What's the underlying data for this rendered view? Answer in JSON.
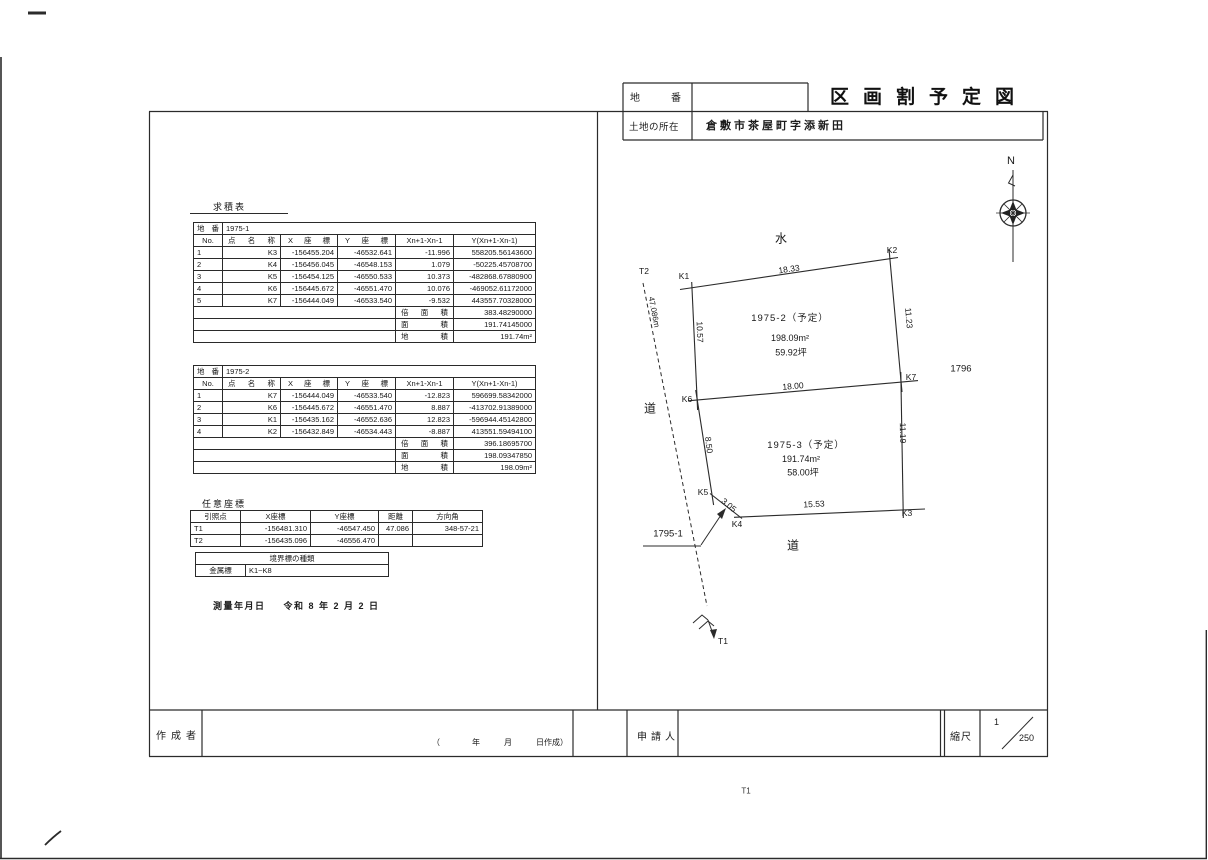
{
  "title_block": {
    "lot_number_label": "地　番",
    "lot_number_value": "",
    "title": "区画割予定図",
    "location_label": "土地の所在",
    "location_value": "倉敷市茶屋町字添新田"
  },
  "tables": {
    "section_label": "求積表",
    "parcel_label": "地番",
    "headers": [
      "No.",
      "点名称",
      "X座標",
      "Y座標",
      "Xn+1-Xn-1",
      "Y(Xn+1-Xn-1)"
    ],
    "t1": {
      "parcel": "1975-1",
      "rows": [
        [
          "1",
          "K3",
          "-156455.204",
          "-46532.641",
          "-11.996",
          "558205.56143600"
        ],
        [
          "2",
          "K4",
          "-156456.045",
          "-46548.153",
          "1.079",
          "-50225.45708700"
        ],
        [
          "3",
          "K5",
          "-156454.125",
          "-46550.533",
          "10.373",
          "-482868.67880900"
        ],
        [
          "4",
          "K6",
          "-156445.672",
          "-46551.470",
          "10.076",
          "-469052.61172000"
        ],
        [
          "5",
          "K7",
          "-156444.049",
          "-46533.540",
          "-9.532",
          "443557.70328000"
        ]
      ],
      "sums": [
        {
          "label": "倍面積",
          "value": "383.48290000"
        },
        {
          "label": "面積",
          "value": "191.74145000"
        },
        {
          "label": "地積",
          "value": "191.74m²"
        }
      ]
    },
    "t2": {
      "parcel": "1975-2",
      "rows": [
        [
          "1",
          "K7",
          "-156444.049",
          "-46533.540",
          "-12.823",
          "596699.58342000"
        ],
        [
          "2",
          "K6",
          "-156445.672",
          "-46551.470",
          "8.887",
          "-413702.91389000"
        ],
        [
          "3",
          "K1",
          "-156435.162",
          "-46552.636",
          "12.823",
          "-596944.45142800"
        ],
        [
          "4",
          "K2",
          "-156432.849",
          "-46534.443",
          "-8.887",
          "413551.59494100"
        ]
      ],
      "sums": [
        {
          "label": "倍面積",
          "value": "396.18695700"
        },
        {
          "label": "面積",
          "value": "198.09347850"
        },
        {
          "label": "地積",
          "value": "198.09m²"
        }
      ]
    }
  },
  "arbitrary_coords": {
    "section_label": "任意座標",
    "headers": [
      "引照点",
      "X座標",
      "Y座標",
      "距離",
      "方向角"
    ],
    "rows": [
      [
        "T1",
        "-156481.310",
        "-46547.450",
        "47.086",
        "348-57-21"
      ],
      [
        "T2",
        "-156435.096",
        "-46556.470",
        "",
        ""
      ]
    ]
  },
  "boundary_markers": {
    "title": "境界標の種類",
    "type": "金属標",
    "range": "K1~K8"
  },
  "survey_date": {
    "label": "測量年月日",
    "value": "令和 8 年 2 月 2 日"
  },
  "plan": {
    "north_label": "N",
    "water_label": "水",
    "road_left_label": "道",
    "road_bottom_label": "道",
    "points": {
      "k1": "K1",
      "k2": "K2",
      "k3": "K3",
      "k4": "K4",
      "k5": "K5",
      "k6": "K6",
      "k7": "K7",
      "t1": "T1",
      "t2": "T2"
    },
    "dimensions": {
      "k1_k2": "18.33",
      "k2_k7": "11.23",
      "k1_k6": "10.57",
      "k6_k7": "18.00",
      "k6_k5": "8.50",
      "k7_k3": "11.19",
      "k5_k4": "3.05",
      "k4_k3": "15.53",
      "t2_t1": "47.086m"
    },
    "lot_1975_2": {
      "name": "1975-2（予定）",
      "area": "198.09m²",
      "tsubo": "59.92坪"
    },
    "lot_1975_3": {
      "name": "1975-3（予定）",
      "area": "191.74m²",
      "tsubo": "58.00坪"
    },
    "neighbor_right": "1796",
    "neighbor_bottom_left": "1795-1"
  },
  "footer": {
    "creator_label": "作成者",
    "creator_note": "（　　　　年　　　月　　　日作成）",
    "applicant_label": "申請人",
    "scale_label": "縮尺",
    "scale_numerator": "1",
    "scale_denominator": "250"
  },
  "page_footer_mark": "T1"
}
